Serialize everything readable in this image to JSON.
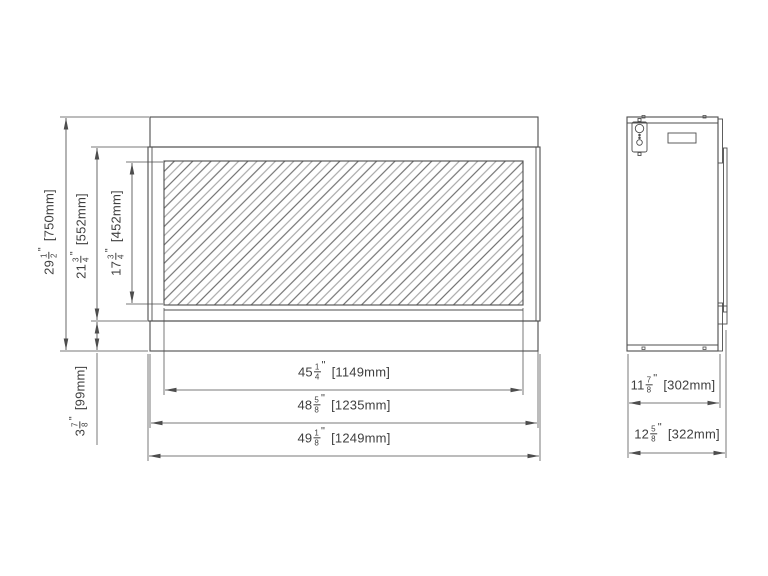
{
  "colors": {
    "background": "#ffffff",
    "line": "#4d4d4d",
    "text": "#3f3f3f",
    "hatch_dark": "#5a5a5a",
    "hatch_light": "#9a9a9a"
  },
  "marks": {
    "inch": "\""
  },
  "front_view": {
    "dimensions": {
      "total_height": {
        "whole": "29",
        "num": "1",
        "den": "2",
        "mm": "[750mm]"
      },
      "body_height": {
        "whole": "21",
        "num": "3",
        "den": "4",
        "mm": "[552mm]"
      },
      "glass_height": {
        "whole": "17",
        "num": "3",
        "den": "4",
        "mm": "[452mm]"
      },
      "base_height": {
        "whole": "3",
        "num": "7",
        "den": "8",
        "mm": "[99mm]"
      },
      "glass_width": {
        "whole": "45",
        "num": "1",
        "den": "4",
        "mm": "[1149mm]"
      },
      "face_width": {
        "whole": "48",
        "num": "5",
        "den": "8",
        "mm": "[1235mm]"
      },
      "overall_width": {
        "whole": "49",
        "num": "1",
        "den": "8",
        "mm": "[1249mm]"
      }
    }
  },
  "side_view": {
    "dimensions": {
      "body_depth": {
        "whole": "11",
        "num": "7",
        "den": "8",
        "mm": "[302mm]"
      },
      "overall_depth": {
        "whole": "12",
        "num": "5",
        "den": "8",
        "mm": "[322mm]"
      }
    }
  }
}
